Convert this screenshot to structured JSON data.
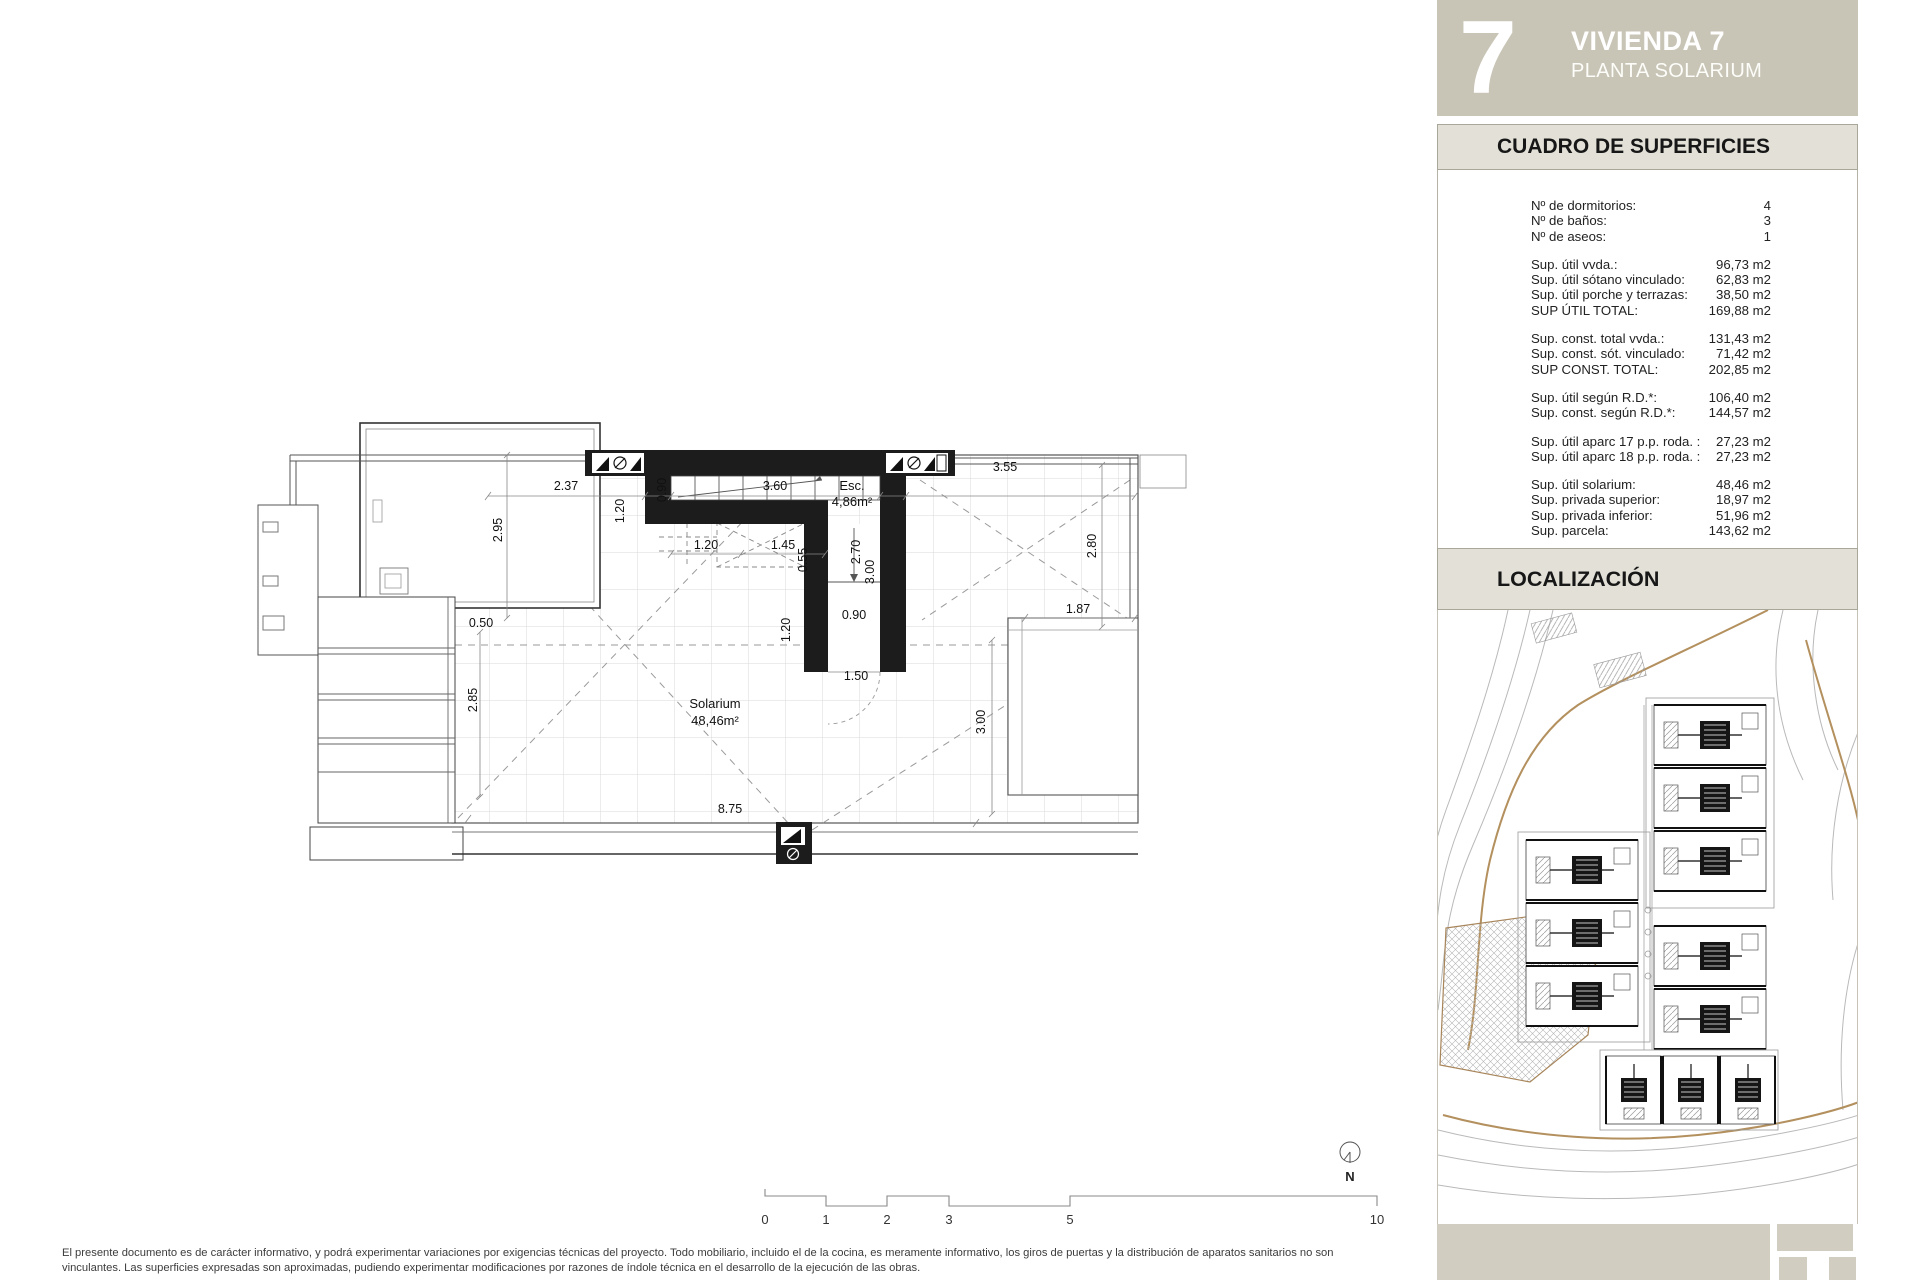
{
  "header": {
    "number": "7",
    "title": "VIVIENDA 7",
    "subtitle": "PLANTA SOLARIUM"
  },
  "surfaces": {
    "title": "CUADRO DE SUPERFICIES",
    "groups": [
      {
        "rows": [
          {
            "label": "Nº de dormitorios:",
            "value": "4"
          },
          {
            "label": "Nº de baños:",
            "value": "3"
          },
          {
            "label": "Nº de aseos:",
            "value": "1"
          }
        ]
      },
      {
        "rows": [
          {
            "label": "Sup. útil vvda.:",
            "value": "96,73 m2"
          },
          {
            "label": "Sup. útil sótano vinculado:",
            "value": "62,83 m2"
          },
          {
            "label": "Sup. útil porche y terrazas:",
            "value": "38,50 m2"
          },
          {
            "label": "SUP ÚTIL TOTAL:",
            "value": "169,88 m2"
          }
        ]
      },
      {
        "rows": [
          {
            "label": "Sup. const. total vvda.:",
            "value": "131,43 m2"
          },
          {
            "label": "Sup. const. sót. vinculado:",
            "value": "71,42 m2"
          },
          {
            "label": "SUP CONST. TOTAL:",
            "value": "202,85 m2"
          }
        ]
      },
      {
        "rows": [
          {
            "label": "Sup. útil según R.D.*:",
            "value": "106,40 m2"
          },
          {
            "label": "Sup. const. según R.D.*:",
            "value": "144,57 m2"
          }
        ]
      },
      {
        "rows": [
          {
            "label": "Sup. útil aparc 17 p.p. roda. :",
            "value": "27,23 m2"
          },
          {
            "label": "Sup. útil aparc 18 p.p. roda. :",
            "value": "27,23 m2"
          }
        ]
      },
      {
        "rows": [
          {
            "label": "Sup. útil solarium:",
            "value": "48,46 m2"
          },
          {
            "label": "Sup. privada superior:",
            "value": "18,97 m2"
          },
          {
            "label": "Sup. privada inferior:",
            "value": "51,96 m2"
          },
          {
            "label": "Sup. parcela:",
            "value": "143,62 m2"
          }
        ]
      }
    ]
  },
  "localizacion": {
    "title": "LOCALIZACIÓN"
  },
  "plan": {
    "rooms": {
      "esc_label": "Esc.",
      "esc_area": "4,86m²",
      "solarium_label": "Solarium",
      "solarium_area": "48,46m²"
    },
    "dims": {
      "t237": "2.37",
      "t360": "3.60",
      "t355": "3.55",
      "h120": "1.20",
      "h145": "1.45",
      "h187": "1.87",
      "h050": "0.50",
      "h090": "0.90",
      "h150": "1.50",
      "h875": "8.75",
      "v090": "0.90",
      "v120a": "1.20",
      "v295": "2.95",
      "v055": "0.55",
      "v270": "2.70",
      "v300a": "3.00",
      "v280": "2.80",
      "v120b": "1.20",
      "v285": "2.85",
      "v300b": "3.00"
    }
  },
  "scalebar": {
    "labels": [
      "0",
      "1",
      "2",
      "3",
      "5",
      "10"
    ]
  },
  "north_label": "N",
  "disclaimer": {
    "line1": "El presente documento es de carácter informativo, y podrá experimentar variaciones por exigencias técnicas del proyecto. Todo mobiliario, incluido el de la cocina, es meramente informativo, los giros de puertas y la distribución de aparatos sanitarios no son",
    "line2": "vinculantes. Las superficies expresadas son aproximadas, pudiendo experimentar modificaciones por razones de índole técnica en el desarrollo de la ejecución de las obras."
  },
  "colors": {
    "sidebar_header_bg": "#c8c4b6",
    "section_bar_bg": "#e3e1d7",
    "footer_logo_bg": "#d1cdc0",
    "map_road": "#b3905e",
    "highlight_unit": "#9b9b9b",
    "wall_black": "#1c1c1c"
  }
}
